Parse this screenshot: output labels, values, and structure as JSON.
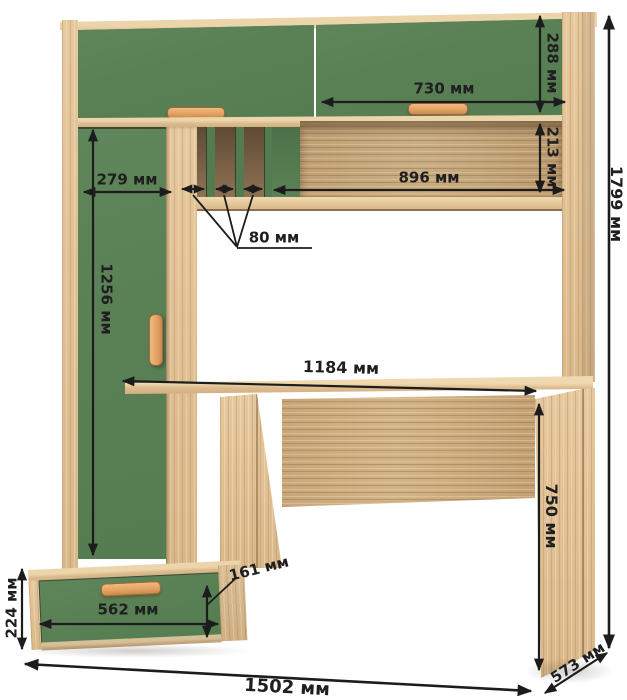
{
  "diagram": {
    "type": "furniture-dimension-drawing",
    "subject": "computer desk with hutch, tall cabinet and drawer base",
    "unit": "мм",
    "dimensions": {
      "total_height": "1799 мм",
      "overall_width": "1502 мм",
      "depth": "573 мм",
      "hutch_door_width": "730 мм",
      "hutch_door_height": "288 мм",
      "shelf_opening_height": "213 мм",
      "shelf_width": "896 мм",
      "column_width": "279 мм",
      "slot_width": "80 мм",
      "tall_door_height": "1256 мм",
      "desktop_width": "1184 мм",
      "desk_height": "750 мм",
      "drawer_front_width": "562 мм",
      "drawer_front_height": "161 мм",
      "base_cabinet_height": "224 мм"
    },
    "colors": {
      "wood_light": "#e0c095",
      "wood_medium": "#c3a77e",
      "green_panel": "#5a8156",
      "handle_wood": "#e2a363",
      "dimension_line": "#1c1c1c",
      "background": "#ffffff"
    }
  }
}
